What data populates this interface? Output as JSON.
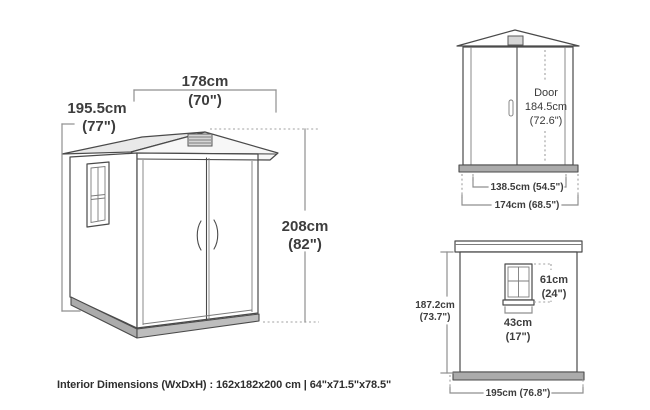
{
  "diagram": {
    "main_view": {
      "width_cm": "178cm",
      "width_in": "(70\")",
      "depth_cm": "195.5cm",
      "depth_in": "(77\")",
      "height_cm": "208cm",
      "height_in": "(82\")"
    },
    "front_view": {
      "door_label": "Door",
      "door_height_cm": "184.5cm",
      "door_height_in": "(72.6\")",
      "door_width": "138.5cm (54.5\")",
      "base_width": "174cm (68.5\")"
    },
    "side_view": {
      "window_height_cm": "61cm",
      "window_height_in": "(24\")",
      "window_width_cm": "43cm",
      "window_width_in": "(17\")",
      "height_cm": "187.2cm",
      "height_in": "(73.7\")",
      "base_depth": "195cm (76.8\")"
    },
    "footer_text": "Interior Dimensions (WxDxH) : 162x182x200 cm | 64\"x71.5\"x78.5\"",
    "colors": {
      "line": "#4a4a4a",
      "dimension_line": "#8f8f8f",
      "text": "#3d3d3d",
      "roof_shade": "#e9e9e9",
      "base_fill": "#ababab"
    }
  }
}
